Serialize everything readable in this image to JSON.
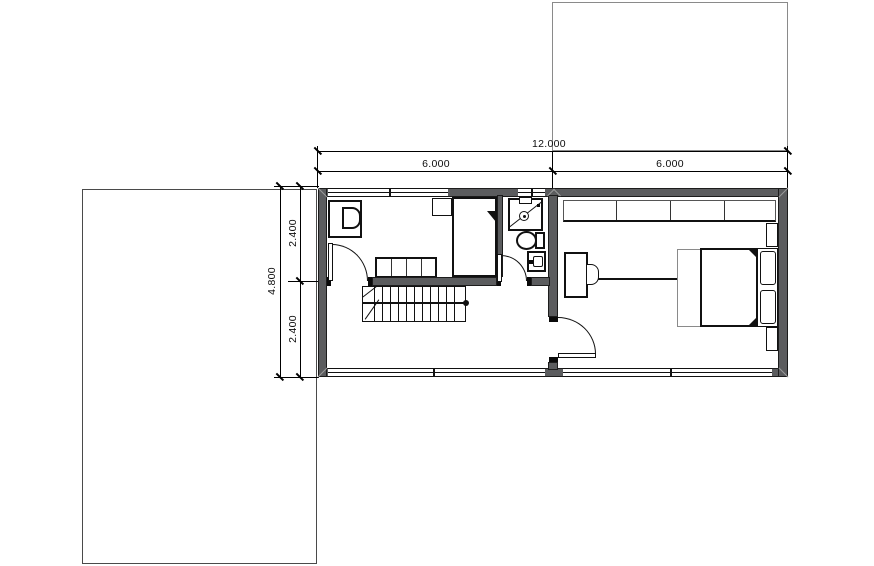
{
  "drawing": {
    "type": "architectural-floor-plan",
    "dims": {
      "top_total": "12.000",
      "top_left": "6.000",
      "top_right": "6.000",
      "left_total": "4.800",
      "left_top": "2.400",
      "left_bottom": "2.400"
    },
    "colors": {
      "wall_fill": "#5b5c5e",
      "line": "#111111",
      "site_outline_upper": "#8a8a8a",
      "site_outline_lower": "#4a4a4a",
      "dimension": "#000000"
    },
    "symbols": [
      "single-bed",
      "double-bed",
      "wardrobe",
      "bench",
      "desk",
      "chair",
      "shower",
      "toilet",
      "sink",
      "staircase",
      "door",
      "window",
      "nightstand",
      "pillow"
    ]
  }
}
